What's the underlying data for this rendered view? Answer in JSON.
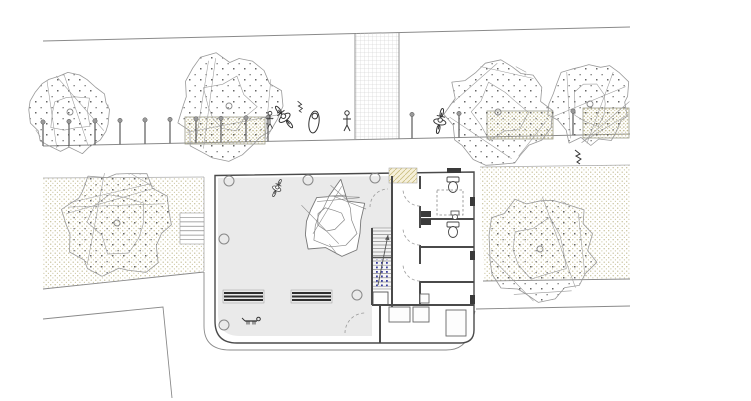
{
  "meta": {
    "title": "Architectural site plan — ground floor with street, sidewalk, courtyard building and gardens",
    "drawing_type": "site-plan"
  },
  "palette": {
    "paper": "#ffffff",
    "line": "#8a8a8a",
    "line_light": "#aaaaaa",
    "wall": "#4a4a4a",
    "wall_dark": "#3a3a3a",
    "courtyard_fill": "#eaeaea",
    "stair_fill": "#f2f2f2",
    "stipple_dot": "#c6c09a",
    "stipple_dense_dot": "#b9b284",
    "tree_dot": "#666666",
    "blue_dot": "#3a3f9e",
    "mat_fill": "#f6f0da",
    "mat_hatch": "#c9bd7f",
    "bench_bar": "#2e2e2e",
    "figure_stroke": "#333333",
    "grid_line": "#c8c8c8"
  },
  "scene": {
    "street": {
      "top_line": [
        43,
        41,
        630,
        27
      ],
      "sidewalk_line": [
        43,
        146,
        630,
        134
      ],
      "crosswalk": {
        "x": 355,
        "y": 33,
        "w": 44,
        "h": 106
      },
      "bollard_xs": [
        43,
        69,
        95,
        120,
        145,
        170,
        196,
        221,
        246,
        268,
        412,
        459,
        573
      ],
      "bollard_height": 24
    },
    "gardens": {
      "left_pts": [
        [
          43,
          178
        ],
        [
          204,
          177
        ],
        [
          204,
          271
        ],
        [
          43,
          289
        ]
      ],
      "right_pts": [
        [
          480,
          167
        ],
        [
          630,
          165
        ],
        [
          630,
          279
        ],
        [
          484,
          281
        ]
      ],
      "left_top_line": [
        43,
        178,
        204,
        177
      ],
      "left_right_edge": [
        204,
        177,
        204,
        271
      ],
      "right_top_line": [
        480,
        167,
        630,
        165
      ],
      "right_lines": [
        [
          483,
          281,
          630,
          279
        ],
        [
          476,
          309,
          630,
          306
        ]
      ],
      "left_bottom_line": [
        43,
        289,
        204,
        272
      ],
      "curb_pts": [
        [
          43,
          319
        ],
        [
          163,
          307
        ],
        [
          172,
          398
        ]
      ],
      "outer_path": "M204,272 L204,326 Q204,350 230,350 L446,350 Q466,350 470,331 L475,311"
    },
    "planters": [
      [
        185,
        117,
        80,
        27
      ],
      [
        487,
        111,
        66,
        28
      ],
      [
        583,
        108,
        46,
        30
      ]
    ],
    "ext_stairs": {
      "x": 180,
      "y": 213,
      "w": 24,
      "h": 31,
      "steps": 7
    },
    "building": {
      "outline": "M215,175.5 L474,172 L474,330 Q474,343 460,343 L237,343 Q215,343 215,321 Z",
      "courtyard": "M218,178 L392,176 L392,228 L372,228 L372,336 L240,336 Q218,336 218,314 Z",
      "walls": [
        [
          392,
          176,
          392,
          307
        ],
        [
          420,
          176,
          420,
          189
        ],
        [
          420,
          206,
          420,
          228
        ],
        [
          420,
          245,
          420,
          264
        ],
        [
          420,
          281,
          420,
          305
        ],
        [
          420,
          219,
          474,
          219
        ],
        [
          420,
          247,
          474,
          247
        ],
        [
          420,
          282,
          474,
          282
        ],
        [
          372,
          305,
          474,
          305
        ],
        [
          380,
          305,
          380,
          343
        ],
        [
          372,
          228,
          372,
          305
        ]
      ],
      "jambs": [
        [
          470,
          197,
          5,
          9
        ],
        [
          470,
          251,
          5,
          9
        ],
        [
          470,
          295,
          5,
          9
        ],
        [
          447,
          168,
          14,
          5
        ]
      ],
      "stair": {
        "x": 372,
        "w": 20,
        "upper_y": 228,
        "upper_h": 29,
        "blue_y": 258,
        "blue_h": 31,
        "closet": [
          373,
          292,
          15,
          13
        ],
        "arrow": [
          378,
          285,
          388,
          235
        ]
      },
      "mat": [
        389,
        168,
        28,
        15
      ],
      "furniture": [
        [
          389,
          307,
          21,
          15
        ],
        [
          413,
          307,
          16,
          15
        ],
        [
          446,
          310,
          20,
          26
        ],
        [
          420,
          294,
          9,
          9
        ]
      ],
      "toilets": [
        [
          453,
          186
        ],
        [
          453,
          231
        ]
      ],
      "sinks": [
        [
          421,
          211,
          10,
          6
        ],
        [
          421,
          219,
          10,
          6
        ]
      ],
      "urinal": [
        455,
        216
      ],
      "dashed_rect": [
        437,
        190,
        26,
        25
      ],
      "door_arcs": [
        {
          "hx": 420,
          "hy": 189,
          "r": 17,
          "a0": 90,
          "a1": 180
        },
        {
          "hx": 420,
          "hy": 228,
          "r": 17,
          "a0": 90,
          "a1": 180
        },
        {
          "hx": 420,
          "hy": 264,
          "r": 17,
          "a0": 90,
          "a1": 180
        },
        {
          "hx": 388,
          "hy": 207,
          "r": 18,
          "a0": 180,
          "a1": 270
        },
        {
          "hx": 365,
          "hy": 333,
          "r": 20,
          "a0": 180,
          "a1": 270
        }
      ]
    },
    "benches": [
      {
        "x": 223,
        "y": 290,
        "w": 41,
        "h": 13
      },
      {
        "x": 291,
        "y": 290,
        "w": 41,
        "h": 13
      }
    ],
    "ground_circles": [
      [
        229,
        181
      ],
      [
        308,
        180
      ],
      [
        375,
        178
      ],
      [
        224,
        239
      ],
      [
        357,
        295
      ],
      [
        224,
        325
      ]
    ],
    "trees": [
      {
        "cx": 70,
        "cy": 112,
        "r": 42,
        "seed": 11,
        "kind": "dotted"
      },
      {
        "cx": 117,
        "cy": 223,
        "r": 56,
        "seed": 22,
        "kind": "dotted"
      },
      {
        "cx": 229,
        "cy": 106,
        "r": 54,
        "seed": 33,
        "kind": "dotted"
      },
      {
        "cx": 498,
        "cy": 112,
        "r": 53,
        "seed": 44,
        "kind": "dotted"
      },
      {
        "cx": 590,
        "cy": 104,
        "r": 43,
        "seed": 55,
        "kind": "dotted"
      },
      {
        "cx": 540,
        "cy": 249,
        "r": 57,
        "seed": 66,
        "kind": "dotted"
      },
      {
        "cx": 333,
        "cy": 220,
        "r": 41,
        "seed": 77,
        "kind": "origami"
      }
    ],
    "people": [
      {
        "type": "cyclist",
        "x": 284,
        "y": 117,
        "rot": -38,
        "s": 1
      },
      {
        "type": "stander",
        "x": 270,
        "y": 120,
        "rot": 0,
        "s": 0.85
      },
      {
        "type": "walker",
        "x": 314,
        "y": 122,
        "rot": 8,
        "s": 1
      },
      {
        "type": "stander",
        "x": 347,
        "y": 121,
        "rot": 0,
        "s": 1
      },
      {
        "type": "cyclist",
        "x": 440,
        "y": 121,
        "rot": 12,
        "s": 0.95
      },
      {
        "type": "scribble",
        "x": 578,
        "y": 156,
        "rot": 0,
        "s": 1
      },
      {
        "type": "cyclist",
        "x": 277,
        "y": 188,
        "rot": 25,
        "s": 0.7
      },
      {
        "type": "scribble",
        "x": 300,
        "y": 106,
        "rot": 0,
        "s": 0.8
      },
      {
        "type": "dog",
        "x": 251,
        "y": 321,
        "rot": 0,
        "s": 1
      }
    ]
  }
}
